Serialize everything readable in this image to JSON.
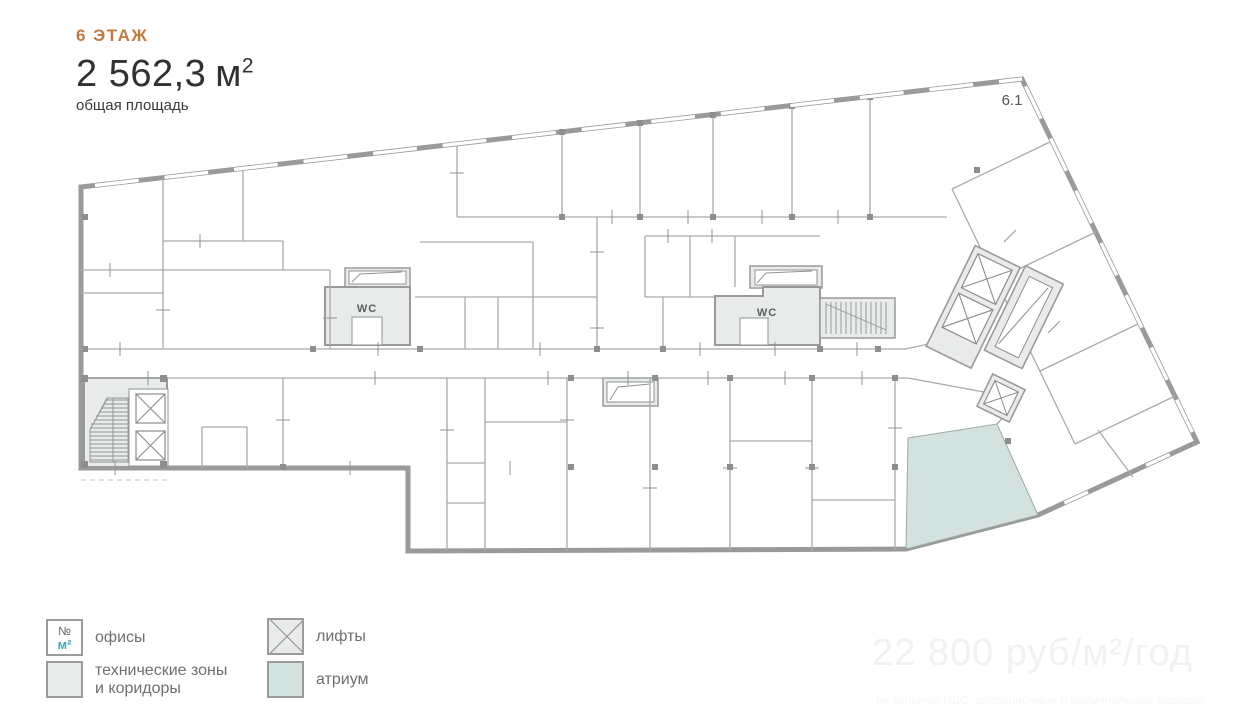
{
  "header": {
    "floor_label": "6 ЭТАЖ",
    "area_value": "2 562,3",
    "area_unit": "м",
    "area_superscript": "2",
    "area_caption": "общая площадь"
  },
  "plan": {
    "unit_label": "6.1",
    "wc_left_label": "WC",
    "wc_right_label": "WC"
  },
  "legend": {
    "offices_icon": {
      "line1": "№",
      "line2": "м²"
    },
    "items": [
      {
        "label": "офисы"
      },
      {
        "label": "технические зоны\nи коридоры"
      },
      {
        "label": "лифты"
      },
      {
        "label": "атриум"
      }
    ]
  },
  "watermark": {
    "price": "22 800 руб/м²/год",
    "fine_print": "не включая НДС, операционные и коммунальные расходы"
  },
  "colors": {
    "accent_orange": "#c1793e",
    "text_dark": "#313131",
    "legend_text_gray": "#6f6f6f",
    "wall_gray": "#9a9a9a",
    "partition_gray": "#a6abae",
    "zone_fill_gray": "#e9eaea",
    "atrium_fill_teal": "#d3e2de",
    "m2_teal": "#4fa3b8",
    "watermark_gray": "#f1f1f1"
  }
}
